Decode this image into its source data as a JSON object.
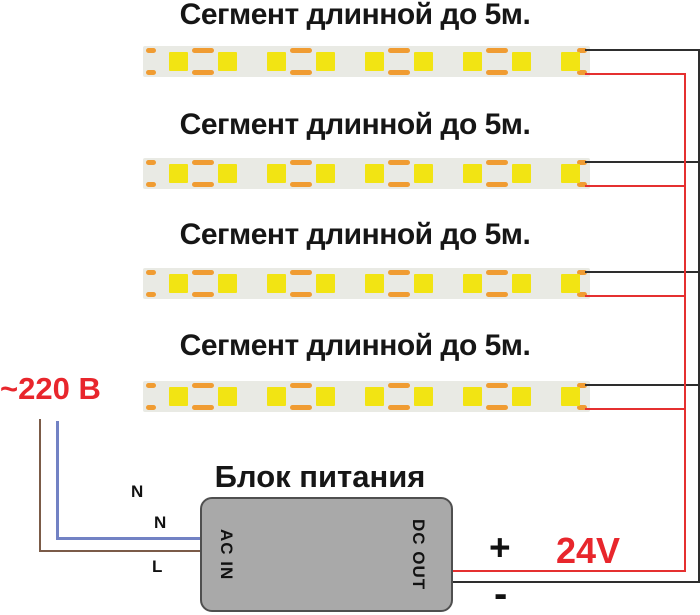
{
  "segments": [
    {
      "label": "Сегмент длинной до 5м."
    },
    {
      "label": "Сегмент длинной до 5м."
    },
    {
      "label": "Сегмент длинной до 5м."
    },
    {
      "label": "Сегмент длинной до 5м."
    }
  ],
  "led_strip": {
    "led_count": 9,
    "cut_mark_count": 4
  },
  "power_supply": {
    "title": "Блок питания",
    "input_label": "AC IN",
    "output_label": "DC OUT"
  },
  "ac_input": {
    "voltage": "~220 В",
    "labels": [
      "N",
      "N",
      "L"
    ]
  },
  "dc_output": {
    "plus": "+",
    "minus": "-",
    "voltage": "24V"
  },
  "colors": {
    "red_text": "#e8262c",
    "wire_red": "#e53030",
    "wire_black": "#2e2e2e",
    "wire_blue": "#7282c4",
    "wire_brown": "#7b5b48",
    "led_yellow": "#f2e413",
    "pad_orange": "#f09c32",
    "strip_bg": "#e9eae4",
    "psu_fill": "#a9a9a9",
    "psu_border": "#4f4f4f"
  }
}
